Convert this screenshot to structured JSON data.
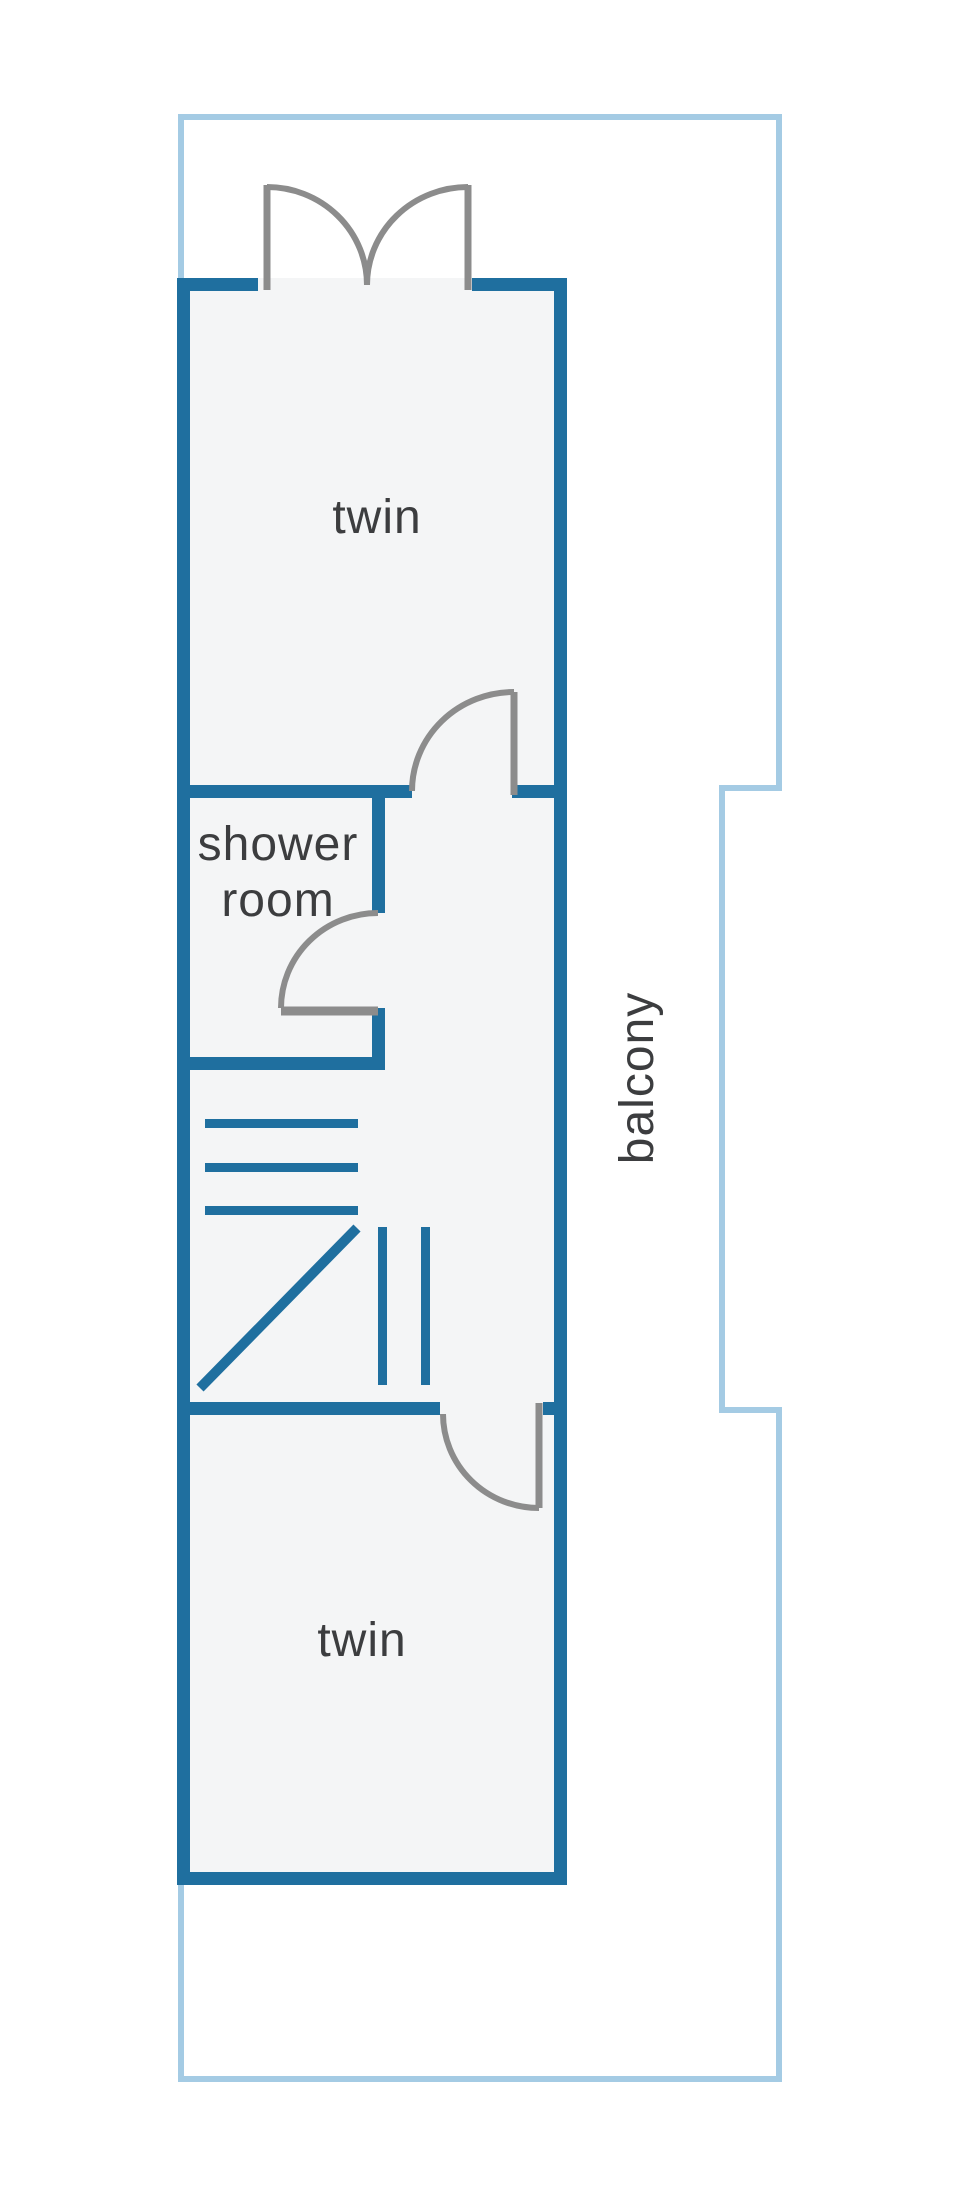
{
  "floorplan": {
    "labels": {
      "twin_top": "twin",
      "shower_room": "shower room",
      "twin_bottom": "twin",
      "balcony": "balcony"
    },
    "colors": {
      "wall": "#1f6f9f",
      "balcony_outline": "#a4cbe4",
      "door": "#8c8c8c",
      "room_fill": "#f4f5f6",
      "label_text": "#3c3d3f",
      "background": "#ffffff"
    }
  }
}
